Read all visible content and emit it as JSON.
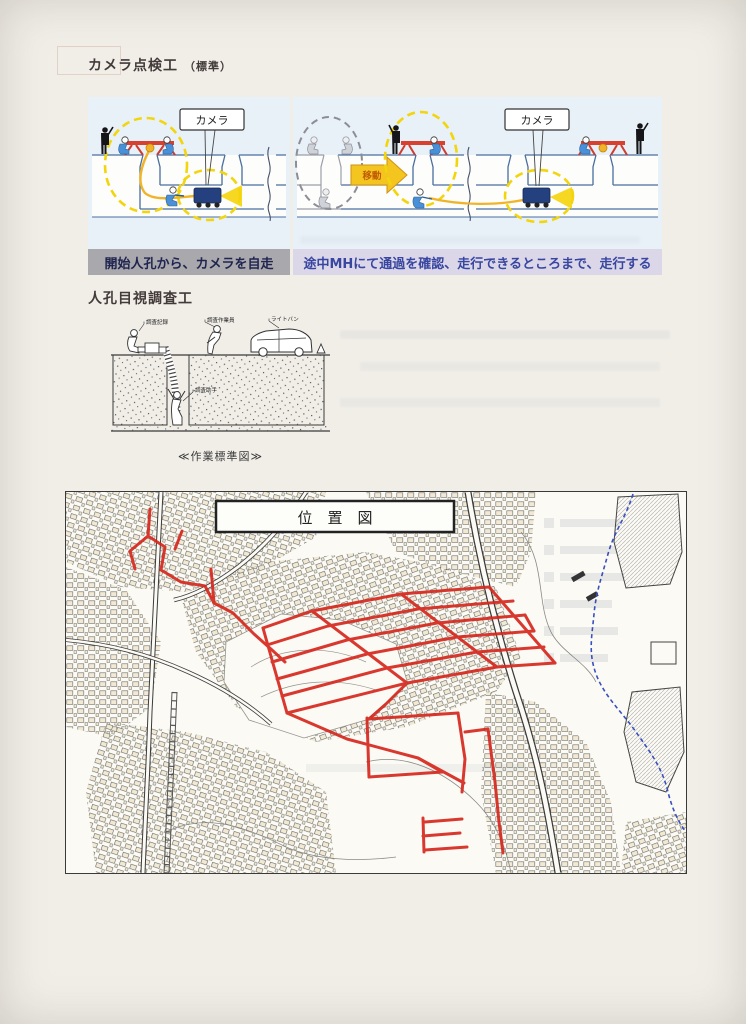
{
  "document": {
    "section_camera": {
      "title_main": "カメラ点検工",
      "title_sub": "（標準）",
      "panel_left": {
        "camera_label": "カメラ",
        "caption": "開始人孔から、カメラを自走"
      },
      "panel_right": {
        "camera_label": "カメラ",
        "move_label": "移動",
        "caption": "途中MHにて通過を確認、走行できるところまで、走行する"
      }
    },
    "section_manhole": {
      "title": "人孔目視調査工",
      "labels": {
        "record": "調査記録",
        "worker": "調査作業員",
        "van": "ライトバン",
        "assistant": "調査助手"
      },
      "caption": "≪作業標準図≫"
    },
    "map": {
      "title": "位　置　図"
    }
  },
  "colors": {
    "paper": "#f1eee8",
    "panel_bg": "#e8f1f7",
    "caption_gray_bg": "#a9a8ad",
    "caption_purple_bg": "#dbd6e8",
    "caption_text_dark": "#20254f",
    "caption_text_blue": "#3846a0",
    "route_red": "#d6281e",
    "barrier_red": "#d8402f",
    "cable_yellow": "#f0b429",
    "dash_yellow": "#f2d50c",
    "robot_navy": "#24407e",
    "stream_blue": "#3a50c0",
    "ground_blue": "#4a6fa0"
  }
}
